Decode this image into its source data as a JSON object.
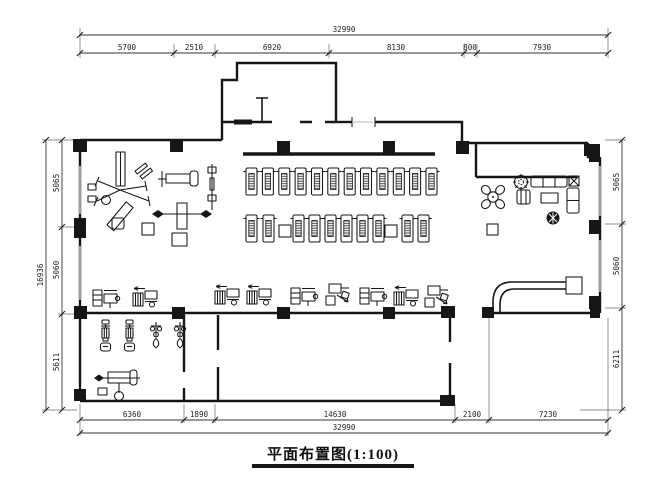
{
  "title": {
    "text": "平面布置图(1:100)"
  },
  "dimensions": {
    "top": {
      "overall": "32990",
      "segments": [
        "5700",
        "2510",
        "6920",
        "8130",
        "800",
        "7930"
      ]
    },
    "bottom": {
      "overall": "32990",
      "segments": [
        "6360",
        "1890",
        "14630",
        "2100",
        "7230"
      ]
    },
    "left": {
      "overall": "16936",
      "segments": [
        "5065",
        "5060",
        "5611"
      ]
    },
    "right": {
      "segments": [
        "5065",
        "5060",
        "6211"
      ]
    }
  },
  "counts": {
    "treadmills_row1": 12,
    "treadmills_row2": 10,
    "strength_machine_row": 7
  },
  "colors": {
    "line": "#161616",
    "window_glass": "#9b9b9b",
    "paper": "#ffffff",
    "belt_hatch": "#444444"
  },
  "icons": {
    "equipment": [
      "multi-station-gym-icon",
      "bench-press-icon",
      "barbell-rack-icon",
      "weight-bench-icon",
      "treadmill-icon",
      "strength-machine-icon",
      "exercise-bike-icon",
      "elliptical-icon"
    ],
    "furniture": [
      "round-table-icon",
      "chair-icon",
      "sofa-icon",
      "armchair-icon",
      "coffee-table-icon",
      "plant-icon",
      "side-table-icon"
    ],
    "structure": [
      "column-icon",
      "window-icon",
      "curved-partition-icon",
      "entrance-vestibule"
    ]
  }
}
